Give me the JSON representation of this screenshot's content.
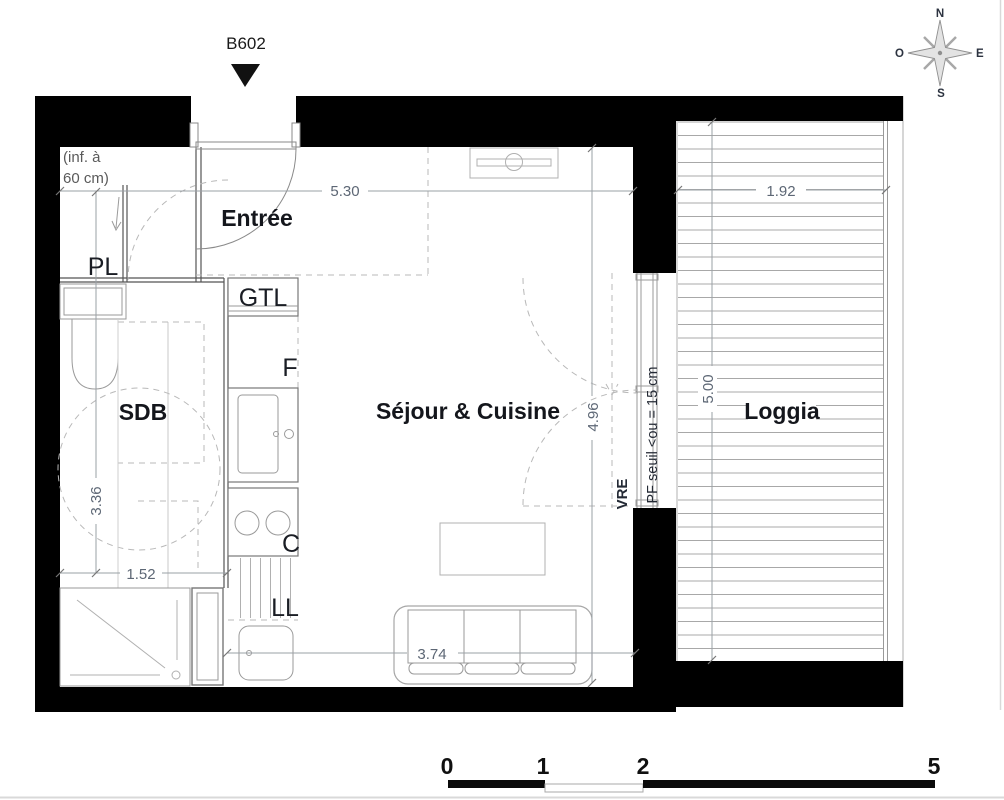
{
  "unit": {
    "label": "B602"
  },
  "compass": {
    "n": "N",
    "e": "E",
    "s": "S",
    "o": "O"
  },
  "rooms": {
    "entree": "Entrée",
    "pl": "PL",
    "sdb": "SDB",
    "sejour": "Séjour & Cuisine",
    "loggia": "Loggia"
  },
  "equipment": {
    "gtl": "GTL",
    "fridge": "F",
    "cooktop": "C",
    "washer": "LL",
    "vre": "VRE"
  },
  "notes": {
    "ceiling_line1": "(inf. à",
    "ceiling_line2": "60 cm)",
    "window_sill": "PF seuil <ou = 15 cm"
  },
  "dimensions": {
    "entree_width": "5.30",
    "sejour_width": "3.74",
    "sejour_depth": "4.96",
    "sdb_width": "1.52",
    "sdb_depth": "3.36",
    "loggia_width": "1.92",
    "loggia_depth": "5.00"
  },
  "scale_bar": {
    "tick0": "0",
    "tick1": "1",
    "tick2": "2",
    "tick5": "5"
  },
  "colors": {
    "wall": "#000000",
    "label_text": "#14161c",
    "dimension_text": "#5d6775",
    "plan_line": "#8a8a8a",
    "deck_line": "#a8a8a8"
  }
}
